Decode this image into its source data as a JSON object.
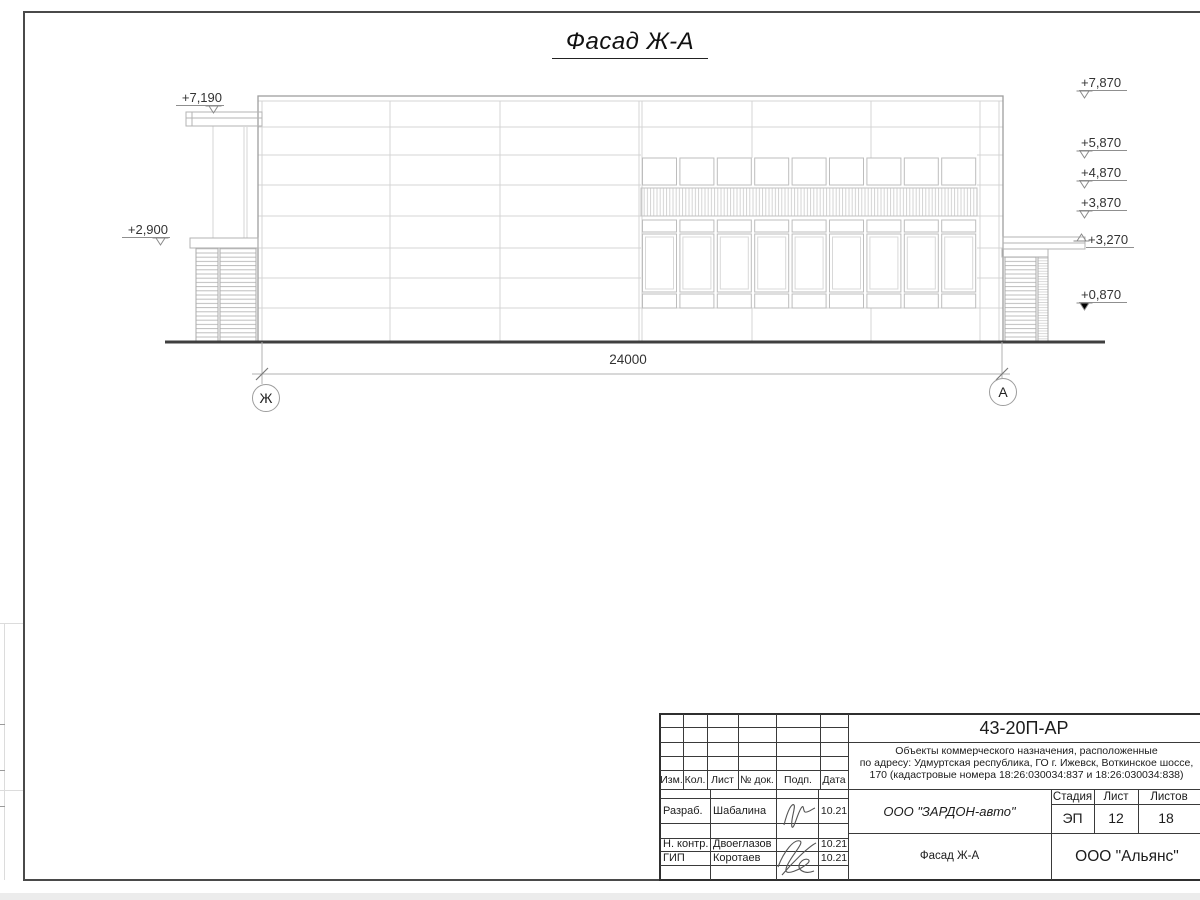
{
  "title": "Фасад Ж-А",
  "dimension": "24000",
  "axes": [
    "Ж",
    "А"
  ],
  "elevations_left": [
    "+7,190",
    "+2,900"
  ],
  "elevations_right": [
    "+7,870",
    "+5,870",
    "+4,870",
    "+3,870",
    "+3,270",
    "+0,870"
  ],
  "title_block": {
    "code": "43-20П-АР",
    "description": [
      "Объекты коммерческого назначения, расположенные",
      "по адресу: Удмуртская республика, ГО г. Ижевск, Воткинское шоссе,",
      "170 (кадастровые номера 18:26:030034:837 и 18:26:030034:838)"
    ],
    "rev_headers": [
      "Изм.",
      "Кол.",
      "Лист",
      "№ док.",
      "Подп.",
      "Дата"
    ],
    "signers": [
      {
        "role": "Разраб.",
        "name": "Шабалина",
        "date": "10.21"
      },
      {
        "role": "Н. контр.",
        "name": "Двоеглазов",
        "date": "10.21"
      },
      {
        "role": "ГИП",
        "name": "Коротаев",
        "date": "10.21"
      }
    ],
    "stage_label": "Стадия",
    "sheet_label": "Лист",
    "sheets_label": "Листов",
    "stage": "ЭП",
    "sheet": "12",
    "sheets": "18",
    "contractor": "ООО \"ЗАРДОН-авто\"",
    "drawing_name": "Фасад Ж-А",
    "organization": "ООО \"Альянс\""
  }
}
